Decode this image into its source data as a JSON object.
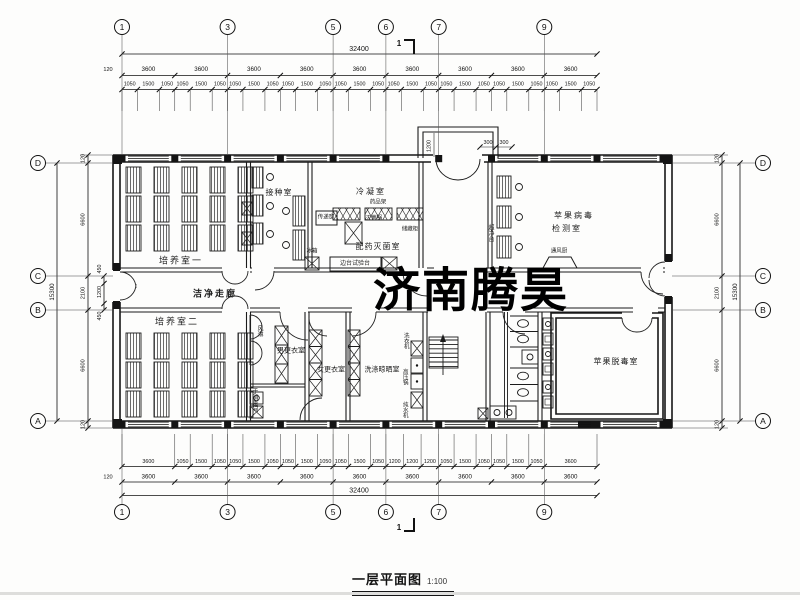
{
  "drawing": {
    "watermark": "济南腾昊",
    "watermark_color": "#df2b33",
    "title": "一层平面图",
    "title_scale": "1:100",
    "section_mark": "1"
  },
  "axes": {
    "horizontal": [
      "1",
      "3",
      "5",
      "6",
      "7",
      "9"
    ],
    "vertical": [
      "D",
      "C",
      "B",
      "A"
    ]
  },
  "dimensions": {
    "top": {
      "total": "32400",
      "edge": "120",
      "bays": [
        "3600",
        "3600",
        "3600",
        "3600",
        "3600",
        "3600",
        "3600",
        "3600",
        "3600"
      ],
      "subs": [
        "1050",
        "1500",
        "1050",
        "1050",
        "1500",
        "1050",
        "1050",
        "1500",
        "1050",
        "1050",
        "1500",
        "1050",
        "1050",
        "1500",
        "1050",
        "1050",
        "1500",
        "1050",
        "1050",
        "1500",
        "1050",
        "1050",
        "1500",
        "1050",
        "1050",
        "1500",
        "1050"
      ]
    },
    "bottom": {
      "total": "32400",
      "edge": "120",
      "bays": [
        "3600",
        "3600",
        "3600",
        "3600",
        "3600",
        "3600",
        "3600",
        "3600",
        "3600"
      ],
      "subs": [
        "3600",
        "1050",
        "1500",
        "1050",
        "1050",
        "1500",
        "1050",
        "1050",
        "1500",
        "1050",
        "1050",
        "1500",
        "1050",
        "1200",
        "1200",
        "1200",
        "1050",
        "1500",
        "1050",
        "1050",
        "1500",
        "1050",
        "3600"
      ]
    },
    "left": {
      "total": "15300",
      "segments": [
        "120",
        "6600",
        "2100",
        "6600",
        "120"
      ],
      "details": [
        "450",
        "1200",
        "450"
      ]
    },
    "right": {
      "total": "15300",
      "segments": [
        "120",
        "6600",
        "2100",
        "6600",
        "120"
      ]
    },
    "entrance": {
      "depth": "1200",
      "steps": [
        "300",
        "300"
      ]
    }
  },
  "rooms": {
    "culture1": "培养室一",
    "inoculation": "接种室",
    "condensation": "冷凝室",
    "prep": "配药灭菌室",
    "virus_test_l1": "苹果病毒",
    "virus_test_l2": "检测室",
    "corridor": "洁净走廊",
    "culture2": "培养室二",
    "men_change": "男更衣室",
    "women_change": "女更衣室",
    "laundry": "洗涤晾晒室",
    "detox": "苹果脱毒室",
    "hand_disinfect": "手消毒间",
    "air_shower": "风淋"
  },
  "equipment": {
    "pass_window": "传递窗",
    "sterilizer": "灭菌锅",
    "cabinet": "储藏柜",
    "reagent_rack": "药品架",
    "fridge": "冰箱",
    "side_bench": "边台试验台",
    "clean_bench": "超净台",
    "fume_hood": "通风厨",
    "washer": "洗衣机",
    "autoclave": "高压锅",
    "water_purifier": "纯水机"
  }
}
